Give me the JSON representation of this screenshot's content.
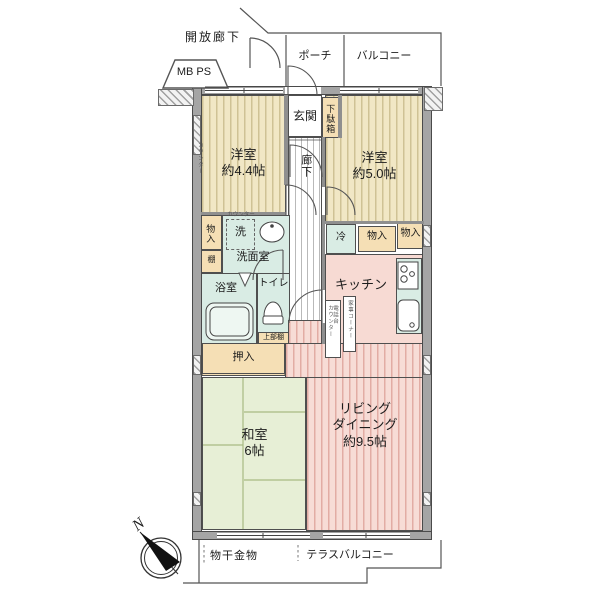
{
  "top": {
    "open_corridor": "開放廊下",
    "mbps": "MB PS",
    "porch": "ポーチ",
    "balcony": "バルコニー"
  },
  "entry": {
    "genkan": "玄関",
    "shoe_box": "下駄箱",
    "hallway": "廊下"
  },
  "rooms": {
    "western1": {
      "name": "洋室",
      "size": "約4.4帖"
    },
    "western2": {
      "name": "洋室",
      "size": "約5.0帖"
    },
    "japanese": {
      "name": "和室",
      "size": "6帖"
    },
    "living": {
      "line1": "リビング",
      "line2": "ダイニング",
      "line3": "約9.5帖"
    },
    "kitchen": "キッチン"
  },
  "water": {
    "washroom": "洗面室",
    "washer": "洗",
    "washer_counter": "カウンター",
    "bath": "浴室",
    "toilet": "トイレ",
    "upper_shelf": "上部棚"
  },
  "storage": {
    "monoire_left": "物入",
    "shelf": "棚",
    "fridge": "冷",
    "monoire_mid": "物入",
    "monoire_right": "物入",
    "oshiire": "押入",
    "wall_counter": "カウンター",
    "phone_stand": "電話台",
    "phone_counter": "カウンター",
    "housework_corner": "家事コーナー"
  },
  "bottom": {
    "laundry_hardware": "物干金物",
    "terrace_balcony": "テラスバルコニー",
    "compass_n": "N"
  }
}
